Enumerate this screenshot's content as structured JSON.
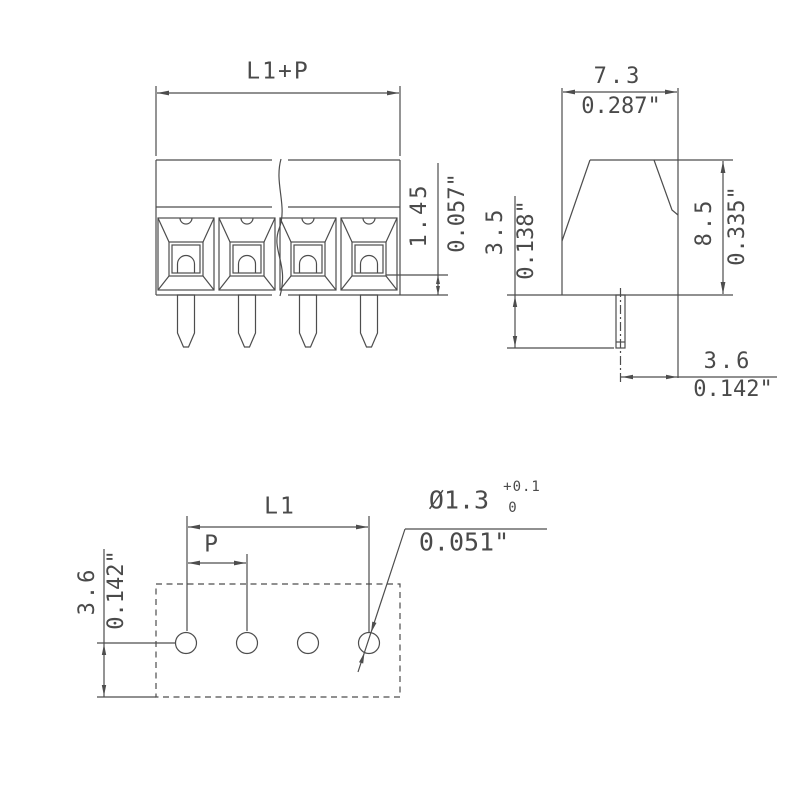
{
  "drawing": {
    "front_view": {
      "dim_total_width": "L1+P",
      "dim_wire_stop": {
        "mm": "1.45",
        "inch": "0.057\""
      }
    },
    "side_view": {
      "dim_width": {
        "mm": "7.3",
        "inch": "0.287\""
      },
      "dim_pin_length": {
        "mm": "3.5",
        "inch": "0.138\""
      },
      "dim_height": {
        "mm": "8.5",
        "inch": "0.335\""
      },
      "dim_pin_to_edge": {
        "mm": "3.6",
        "inch": "0.142\""
      }
    },
    "board_view": {
      "dim_l1": "L1",
      "dim_pitch": "P",
      "dim_row_offset": {
        "mm": "3.6",
        "inch": "0.142\""
      },
      "hole_callout": {
        "diameter": "Ø1.3",
        "tol_plus": "+0.1",
        "tol_minus": "0",
        "inch": "0.051\""
      }
    }
  },
  "colors": {
    "background": "#ffffff",
    "line": "#4d4d4d",
    "text": "#4a4a4a"
  }
}
